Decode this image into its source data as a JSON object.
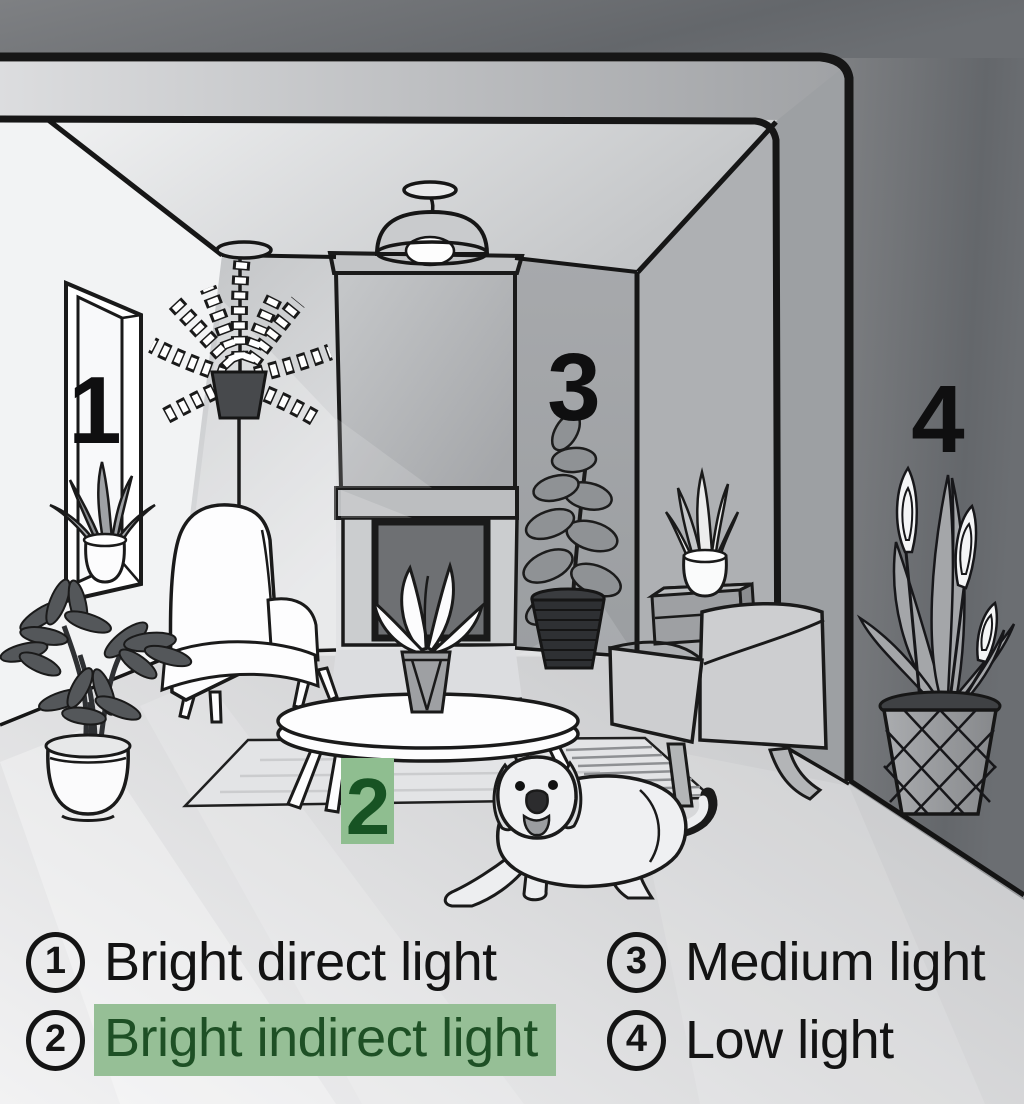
{
  "scene": {
    "numbers": {
      "n1": "1",
      "n2": "2",
      "n3": "3",
      "n4": "4"
    },
    "highlight": {
      "box_fill": "#8fbe90",
      "box_text": "#175323"
    },
    "objects": [
      "window",
      "snake-plant-sill",
      "schefflera-plant",
      "hanging-fern",
      "pendant-lamp",
      "fireplace",
      "wingback-armchair",
      "coffee-table",
      "table-plant",
      "rug",
      "rubber-plant",
      "side-table",
      "snake-plant-side-table",
      "modern-armchair",
      "dog",
      "peace-lily-basket"
    ]
  },
  "legend": {
    "items": [
      {
        "num": "1",
        "label": "Bright direct light",
        "highlighted": false
      },
      {
        "num": "2",
        "label": "Bright indirect light",
        "highlighted": true
      },
      {
        "num": "3",
        "label": "Medium light",
        "highlighted": false
      },
      {
        "num": "4",
        "label": "Low light",
        "highlighted": false
      }
    ],
    "highlight_colors": {
      "bg": "#96bf96",
      "text": "#1e5025"
    },
    "ink": "#1a1a1a"
  }
}
